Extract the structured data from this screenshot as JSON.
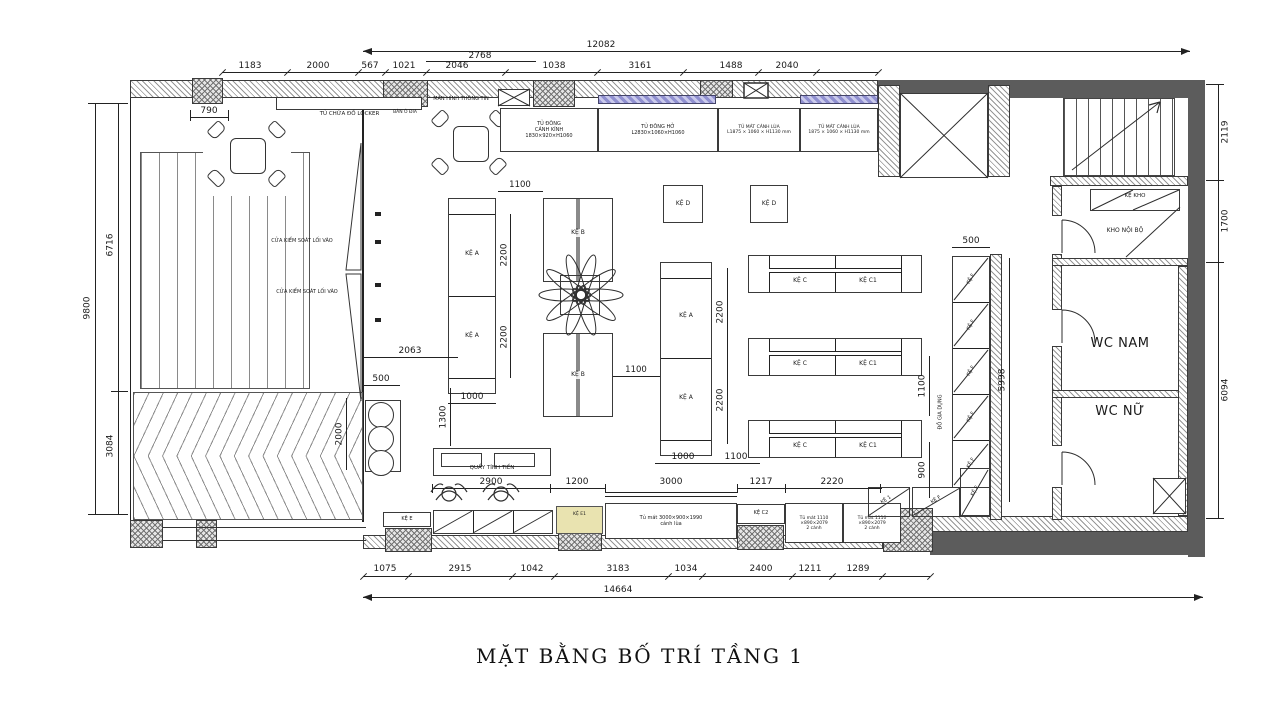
{
  "title": "MẶT BẰNG BỐ TRÍ TẦNG 1",
  "colors": {
    "wall_dark": "#5c5c5c",
    "glass_band": "#8f8fcf",
    "shelf_yellow": "#e9e3b0"
  },
  "rooms": {
    "wc_nam": "WC NAM",
    "wc_nu": "WC NỮ",
    "kho_noi_bo": "KHO NỘI BỘ"
  },
  "fixtures": {
    "locker": "TỦ CHỨA ĐỒ LOCKER",
    "ban_o_dia": "BÀN Ô ĐIA",
    "man_hinh": "MÀN HÌNH THÔNG TIN",
    "tu_dong_canh_kinh": [
      "TỦ ĐÔNG",
      "CÁNH KÍNH",
      "1830×920×H1060"
    ],
    "tu_dong_ho": [
      "TỦ ĐÔNG HỞ",
      "L2830×1060×H1060"
    ],
    "tu_mat_canh_lua_l": [
      "TỦ MÁT CÁNH LÙA",
      "L1875 × 1060 × H1130 mm"
    ],
    "tu_mat_canh_lua_r": [
      "TỦ MÁT CÁNH LÙA",
      "1875 × 1060 × H1130 mm"
    ],
    "cua_kiem_soat": "CỬA KIỂM SOÁT LỐI VÀO",
    "quay_tinh_tien": "QUẦY TÍNH TIỀN",
    "tu_mat_3000": [
      "Tủ mát 3000×900×1990",
      "cánh lùa"
    ],
    "tu_mat_1110": [
      "Tủ mát 1110",
      "×890×2079",
      "2 cánh"
    ],
    "ke_kho": "KỆ KHO",
    "do_gia_dung": "ĐỒ GIA DỤNG",
    "ke_a": "KỆ A",
    "ke_b": "KỆ B",
    "ke_c": "KỆ C",
    "ke_c1": "KỆ C1",
    "ke_c2": "KỆ C2",
    "ke_d": "KỆ D",
    "ke_e": "KỆ E",
    "ke_e1": "KỆ E1",
    "ke_f": "KỆ F",
    "ke_1": "KỆ 1"
  },
  "dims": {
    "top_total": "12082",
    "top_sub": "2768",
    "top_chain": [
      "1183",
      "2000",
      "567",
      "1021",
      "2046",
      "1038",
      "3161",
      "1488",
      "2040"
    ],
    "d790": "790",
    "left_total": "9800",
    "left_upper": "6716",
    "left_lower": "3084",
    "right_upper": "2119",
    "right_mid": "1700",
    "right_lower": "6094",
    "mid_chain": [
      "2900",
      "1200",
      "3000",
      "1217",
      "2220"
    ],
    "bottom_chain": [
      "1075",
      "2915",
      "1042",
      "3183",
      "1034",
      "2400",
      "1211",
      "1289"
    ],
    "bottom_total": "14664",
    "aisle_1100": "1100",
    "shelf_2200": "2200",
    "shelf_1000": "1000",
    "d2063": "2063",
    "d500": "500",
    "d2000": "2000",
    "d1300": "1300",
    "kef_5998": "5998",
    "row_900": "900"
  }
}
